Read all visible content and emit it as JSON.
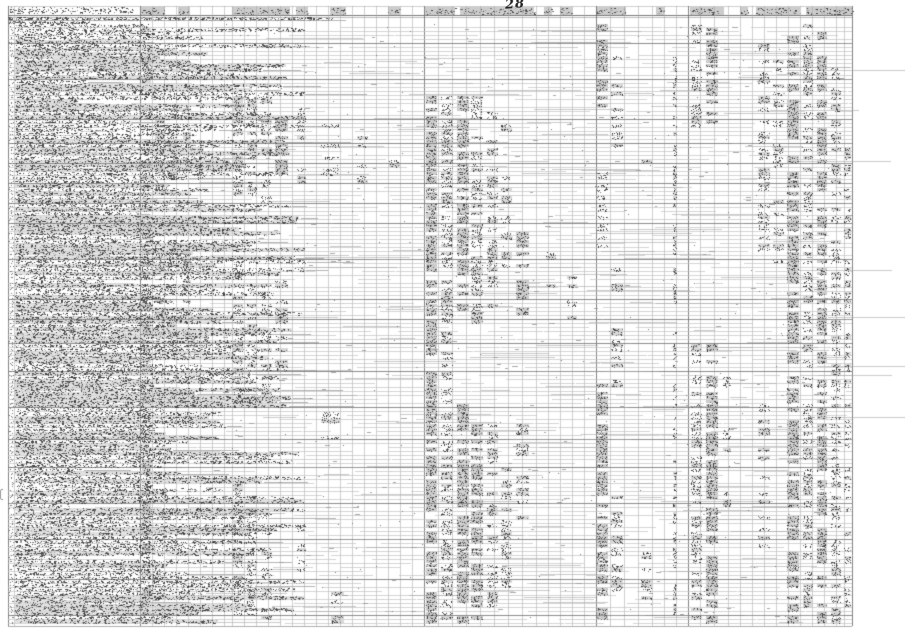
{
  "page": {
    "number": "28"
  },
  "colors": {
    "paper": "#ffffff",
    "grid_light": "#c3c3c3",
    "grid_mid": "#a2a2a2",
    "grid_dark": "#6e6e6e",
    "cell_fill": "#c9c9c9",
    "ink_dark": "#3a3a3a",
    "ink_mid": "#707070",
    "ink_light": "#9b9b9b",
    "pen": "#222222"
  },
  "layout": {
    "width": 905,
    "height": 640,
    "table_left": 8,
    "table_right": 852,
    "header_top": 6,
    "header_rule_dark": 15,
    "header_rule_mid": 17,
    "title_rows": [
      [
        8,
        332,
        17,
        20
      ],
      [
        8,
        90,
        21,
        23
      ]
    ],
    "body_top": 24,
    "row_height": 4,
    "rows": 150,
    "body_bottom_rule": 626,
    "label_left": 15,
    "label_col_right": 140,
    "col_edges": [
      8,
      14,
      140,
      152,
      164,
      176,
      188,
      200,
      212,
      224,
      232,
      244,
      256,
      268,
      280,
      292,
      304,
      316,
      328,
      340,
      352,
      364,
      376,
      388,
      400,
      412,
      424,
      438,
      452,
      466,
      480,
      494,
      508,
      522,
      536,
      548,
      560,
      572,
      584,
      596,
      610,
      624,
      638,
      652,
      664,
      676,
      688,
      700,
      714,
      728,
      740,
      752,
      764,
      776,
      788,
      800,
      812,
      824,
      836,
      844,
      852
    ],
    "dark_cols": [
      8,
      140,
      424,
      596,
      688,
      852
    ],
    "header_cells": [
      [
        141,
        24
      ],
      [
        178,
        12
      ],
      [
        232,
        58
      ],
      [
        296,
        12
      ],
      [
        330,
        16
      ],
      [
        388,
        12
      ],
      [
        425,
        30
      ],
      [
        460,
        74
      ],
      [
        544,
        8
      ],
      [
        560,
        12
      ],
      [
        596,
        30
      ],
      [
        656,
        8
      ],
      [
        690,
        34
      ],
      [
        740,
        8
      ],
      [
        756,
        44
      ],
      [
        806,
        46
      ],
      [
        836,
        14
      ]
    ],
    "bands": [
      [
        141,
        10,
        0,
        149,
        0.85,
        0
      ],
      [
        154,
        11,
        18,
        42,
        0.5,
        0
      ],
      [
        154,
        11,
        60,
        78,
        0.5,
        0
      ],
      [
        154,
        11,
        95,
        120,
        0.35,
        0
      ],
      [
        166,
        11,
        18,
        40,
        0.5,
        0
      ],
      [
        166,
        11,
        55,
        80,
        0.55,
        0
      ],
      [
        182,
        9,
        18,
        40,
        0.4,
        0
      ],
      [
        182,
        9,
        55,
        78,
        0.45,
        0
      ],
      [
        196,
        9,
        19,
        38,
        0.3,
        0
      ],
      [
        232,
        11,
        18,
        42,
        0.6,
        0
      ],
      [
        232,
        11,
        60,
        95,
        0.5,
        0
      ],
      [
        232,
        11,
        115,
        148,
        0.6,
        0
      ],
      [
        246,
        11,
        18,
        42,
        0.55,
        0
      ],
      [
        246,
        11,
        62,
        95,
        0.5,
        0
      ],
      [
        246,
        11,
        118,
        148,
        0.55,
        0
      ],
      [
        260,
        12,
        19,
        45,
        0.5,
        0
      ],
      [
        260,
        12,
        64,
        92,
        0.45,
        0
      ],
      [
        260,
        12,
        120,
        148,
        0.5,
        0
      ],
      [
        274,
        14,
        20,
        40,
        0.5,
        1
      ],
      [
        274,
        14,
        64,
        88,
        0.4,
        0
      ],
      [
        296,
        10,
        20,
        40,
        0.3,
        0
      ],
      [
        296,
        10,
        120,
        140,
        0.3,
        0
      ],
      [
        320,
        20,
        25,
        38,
        0.3,
        0
      ],
      [
        320,
        20,
        96,
        110,
        0.25,
        0
      ],
      [
        330,
        14,
        142,
        149,
        0.45,
        0
      ],
      [
        356,
        12,
        28,
        42,
        0.25,
        0
      ],
      [
        388,
        12,
        30,
        40,
        0.18,
        0
      ],
      [
        425,
        12,
        18,
        149,
        0.8,
        1
      ],
      [
        440,
        13,
        18,
        149,
        0.68,
        0
      ],
      [
        456,
        13,
        18,
        75,
        0.7,
        1
      ],
      [
        456,
        13,
        95,
        149,
        0.7,
        1
      ],
      [
        470,
        13,
        18,
        75,
        0.6,
        0
      ],
      [
        470,
        13,
        100,
        149,
        0.6,
        1
      ],
      [
        486,
        12,
        20,
        70,
        0.5,
        0
      ],
      [
        486,
        12,
        100,
        145,
        0.55,
        0
      ],
      [
        500,
        12,
        25,
        60,
        0.4,
        0
      ],
      [
        500,
        12,
        105,
        140,
        0.45,
        0
      ],
      [
        515,
        14,
        50,
        72,
        0.5,
        1
      ],
      [
        515,
        14,
        100,
        125,
        0.4,
        0
      ],
      [
        545,
        11,
        55,
        70,
        0.3,
        0
      ],
      [
        566,
        11,
        60,
        73,
        0.4,
        0
      ],
      [
        596,
        12,
        0,
        20,
        0.7,
        1
      ],
      [
        596,
        12,
        36,
        55,
        0.6,
        0
      ],
      [
        596,
        12,
        90,
        149,
        0.75,
        1
      ],
      [
        610,
        13,
        8,
        30,
        0.4,
        0
      ],
      [
        610,
        13,
        60,
        90,
        0.4,
        0
      ],
      [
        610,
        13,
        118,
        145,
        0.5,
        0
      ],
      [
        640,
        12,
        30,
        42,
        0.2,
        0
      ],
      [
        640,
        12,
        128,
        145,
        0.4,
        0
      ],
      [
        672,
        5,
        8,
        149,
        0.5,
        0
      ],
      [
        690,
        12,
        0,
        25,
        0.6,
        0
      ],
      [
        690,
        12,
        80,
        149,
        0.65,
        0
      ],
      [
        705,
        13,
        0,
        25,
        0.7,
        1
      ],
      [
        705,
        13,
        80,
        149,
        0.8,
        1
      ],
      [
        722,
        9,
        88,
        120,
        0.3,
        0
      ],
      [
        757,
        13,
        4,
        60,
        0.5,
        0
      ],
      [
        757,
        13,
        95,
        130,
        0.4,
        0
      ],
      [
        772,
        12,
        8,
        60,
        0.45,
        0
      ],
      [
        786,
        13,
        2,
        149,
        0.7,
        1
      ],
      [
        802,
        11,
        0,
        149,
        0.6,
        0
      ],
      [
        816,
        11,
        2,
        149,
        0.7,
        1
      ],
      [
        830,
        11,
        10,
        149,
        0.65,
        0
      ],
      [
        843,
        8,
        30,
        149,
        0.5,
        0
      ]
    ],
    "seed": 20250528,
    "sparse_marks": 650,
    "streaks_per_row": 2
  }
}
